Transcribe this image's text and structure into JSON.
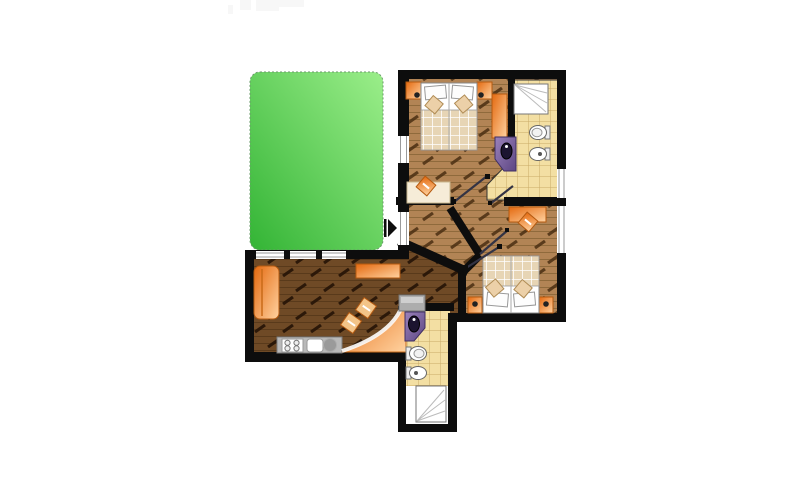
{
  "meta": {
    "view": "apartment-floor-plan",
    "description": "Top-down architectural floor plan of a two-bedroom apartment with two bathrooms, living room with kitchen, central hallway, entrance arrow marker and a green garden terrace at the upper left."
  },
  "colors": {
    "wall": "#0d0d0d",
    "garden_light": "#9bee8a",
    "garden_dark": "#33b435",
    "garden_edge": "#6a9a6a",
    "wood_light": "#b28455",
    "wood_light_line": "#8f6a3c",
    "wood_light_streak": "#4a2d11",
    "wood_dark": "#6f4a26",
    "wood_dark_line": "#593a1b",
    "wood_dark_streak": "#241205",
    "tile": "#f3dfa3",
    "tile_line": "#c9ab67",
    "orange_deep": "#e4690f",
    "orange_light": "#ffd2a0",
    "orange_edge": "#b55a10",
    "purple_light": "#9a82bb",
    "purple_dark": "#5d4683",
    "basin_dark": "#1c1430",
    "fixture_white": "#ffffff",
    "fixture_stroke": "#666666",
    "counter_gray": "#b9b9b9",
    "counter_edge": "#7f7f7f",
    "blanket": "#e7d5b5",
    "blanket_line": "#ffffff",
    "desk_cream": "#f6ecd8",
    "door_leaf": "#333344",
    "window_frame": "#9a9a9a",
    "watermark": "#f7f7f7"
  },
  "rooms": [
    {
      "id": "garden-terrace",
      "kind": "outdoor-green-area"
    },
    {
      "id": "bedroom-1",
      "kind": "bedroom"
    },
    {
      "id": "bathroom-1",
      "kind": "bathroom"
    },
    {
      "id": "hallway",
      "kind": "corridor"
    },
    {
      "id": "bedroom-2",
      "kind": "bedroom"
    },
    {
      "id": "living-room-kitchen",
      "kind": "living-kitchen"
    },
    {
      "id": "bathroom-2",
      "kind": "bathroom"
    },
    {
      "id": "entrance",
      "kind": "entry-marker"
    }
  ],
  "fixtures": [
    "double-bed",
    "nightstand-with-lamp",
    "wardrobe",
    "shower-cabin",
    "toilet",
    "bidet",
    "corner-washbasin",
    "desk-with-chair",
    "sofa",
    "sideboard",
    "kitchen-counter",
    "stove-4-burners",
    "kitchen-sink",
    "round-hob",
    "dining-table-curved",
    "dining-chair",
    "washing-machine",
    "entrance-arrow"
  ]
}
